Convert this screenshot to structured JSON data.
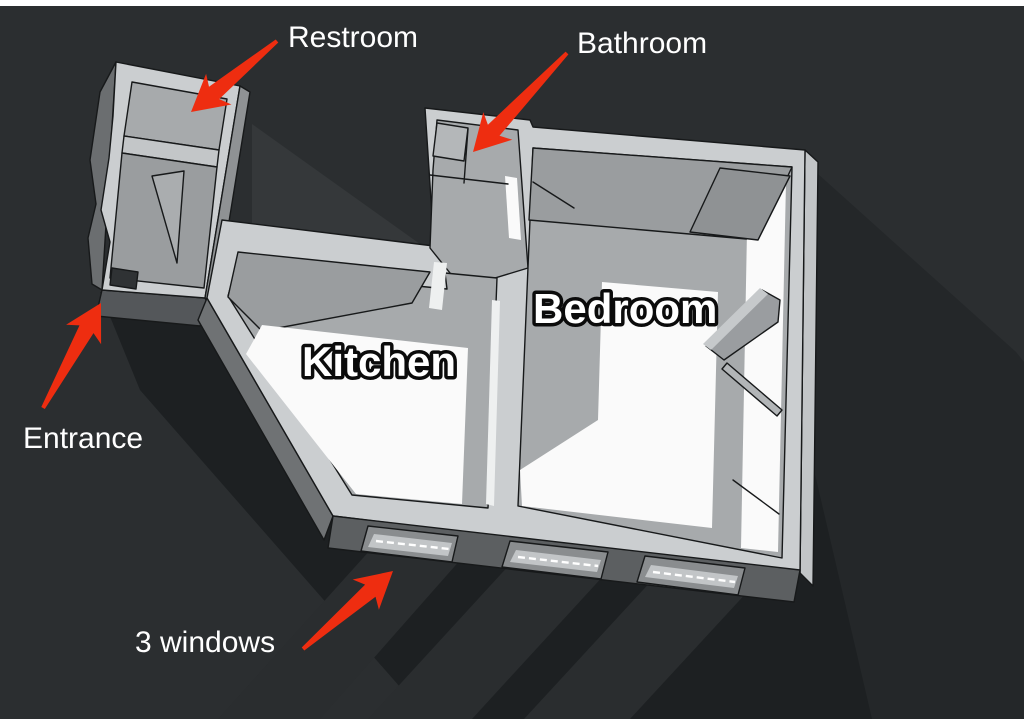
{
  "rooms": {
    "kitchen": {
      "label": "Kitchen"
    },
    "bedroom": {
      "label": "Bedroom"
    }
  },
  "annotations": {
    "restroom": {
      "label": "Restroom"
    },
    "bathroom": {
      "label": "Bathroom"
    },
    "entrance": {
      "label": "Entrance"
    },
    "windows": {
      "label": "3 windows"
    }
  },
  "colors": {
    "background": "#2b2e30",
    "top_strip": "#ffffff",
    "arrow": "#ee2d10",
    "wall_top": "#cbced0",
    "wall_face_light": "#c2c5c7",
    "floor_gray": "#a7aaac",
    "floor_shaded": "#9a9d9f",
    "floor_sunlit": "#fafafa",
    "cast_shadow": "#1d2022",
    "label_text": "#ffffff"
  }
}
